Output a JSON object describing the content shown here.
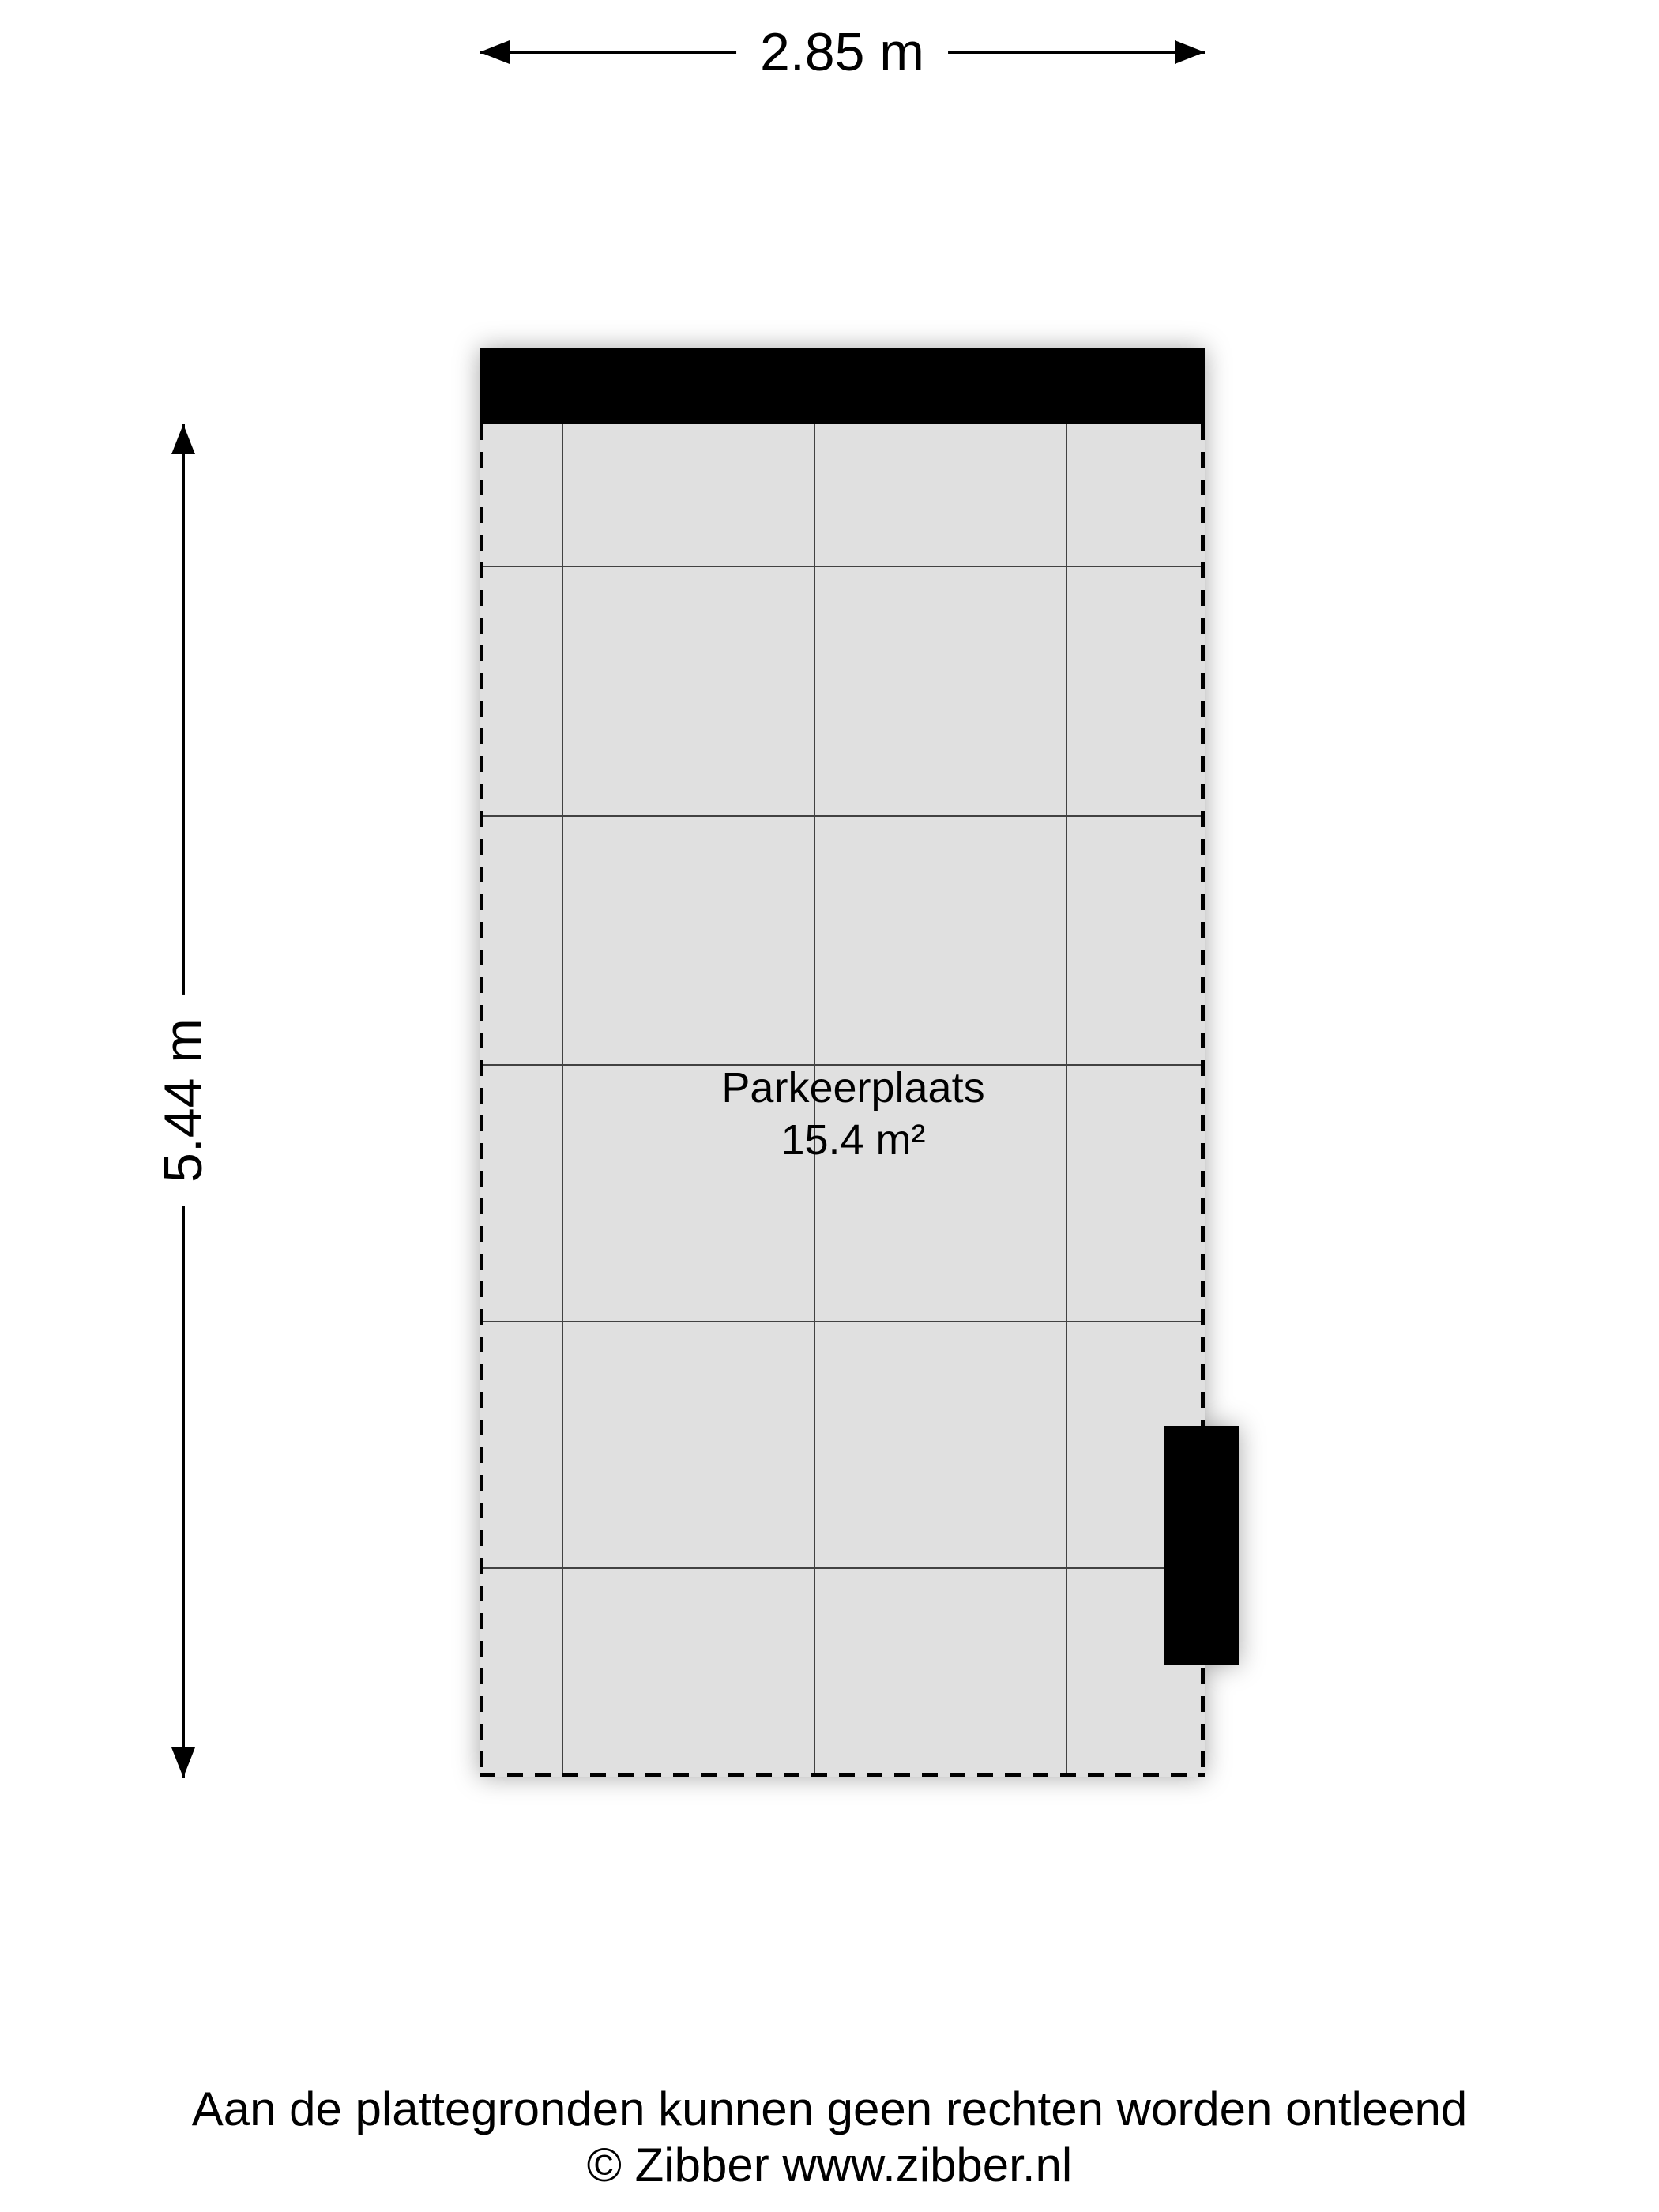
{
  "dimensions": {
    "width": "2.85 m",
    "height": "5.44 m"
  },
  "room": {
    "name": "Parkeerplaats",
    "area": "15.4 m²"
  },
  "footer": {
    "disclaimer": "Aan de plattegronden kunnen geen rechten worden ontleend",
    "copyright": "© Zibber www.zibber.nl"
  },
  "colors": {
    "floor_fill": "#e0e0e0",
    "grid_line": "#424242",
    "wall": "#000000",
    "boundary": "#000000",
    "text": "#000000",
    "background": "#ffffff"
  }
}
